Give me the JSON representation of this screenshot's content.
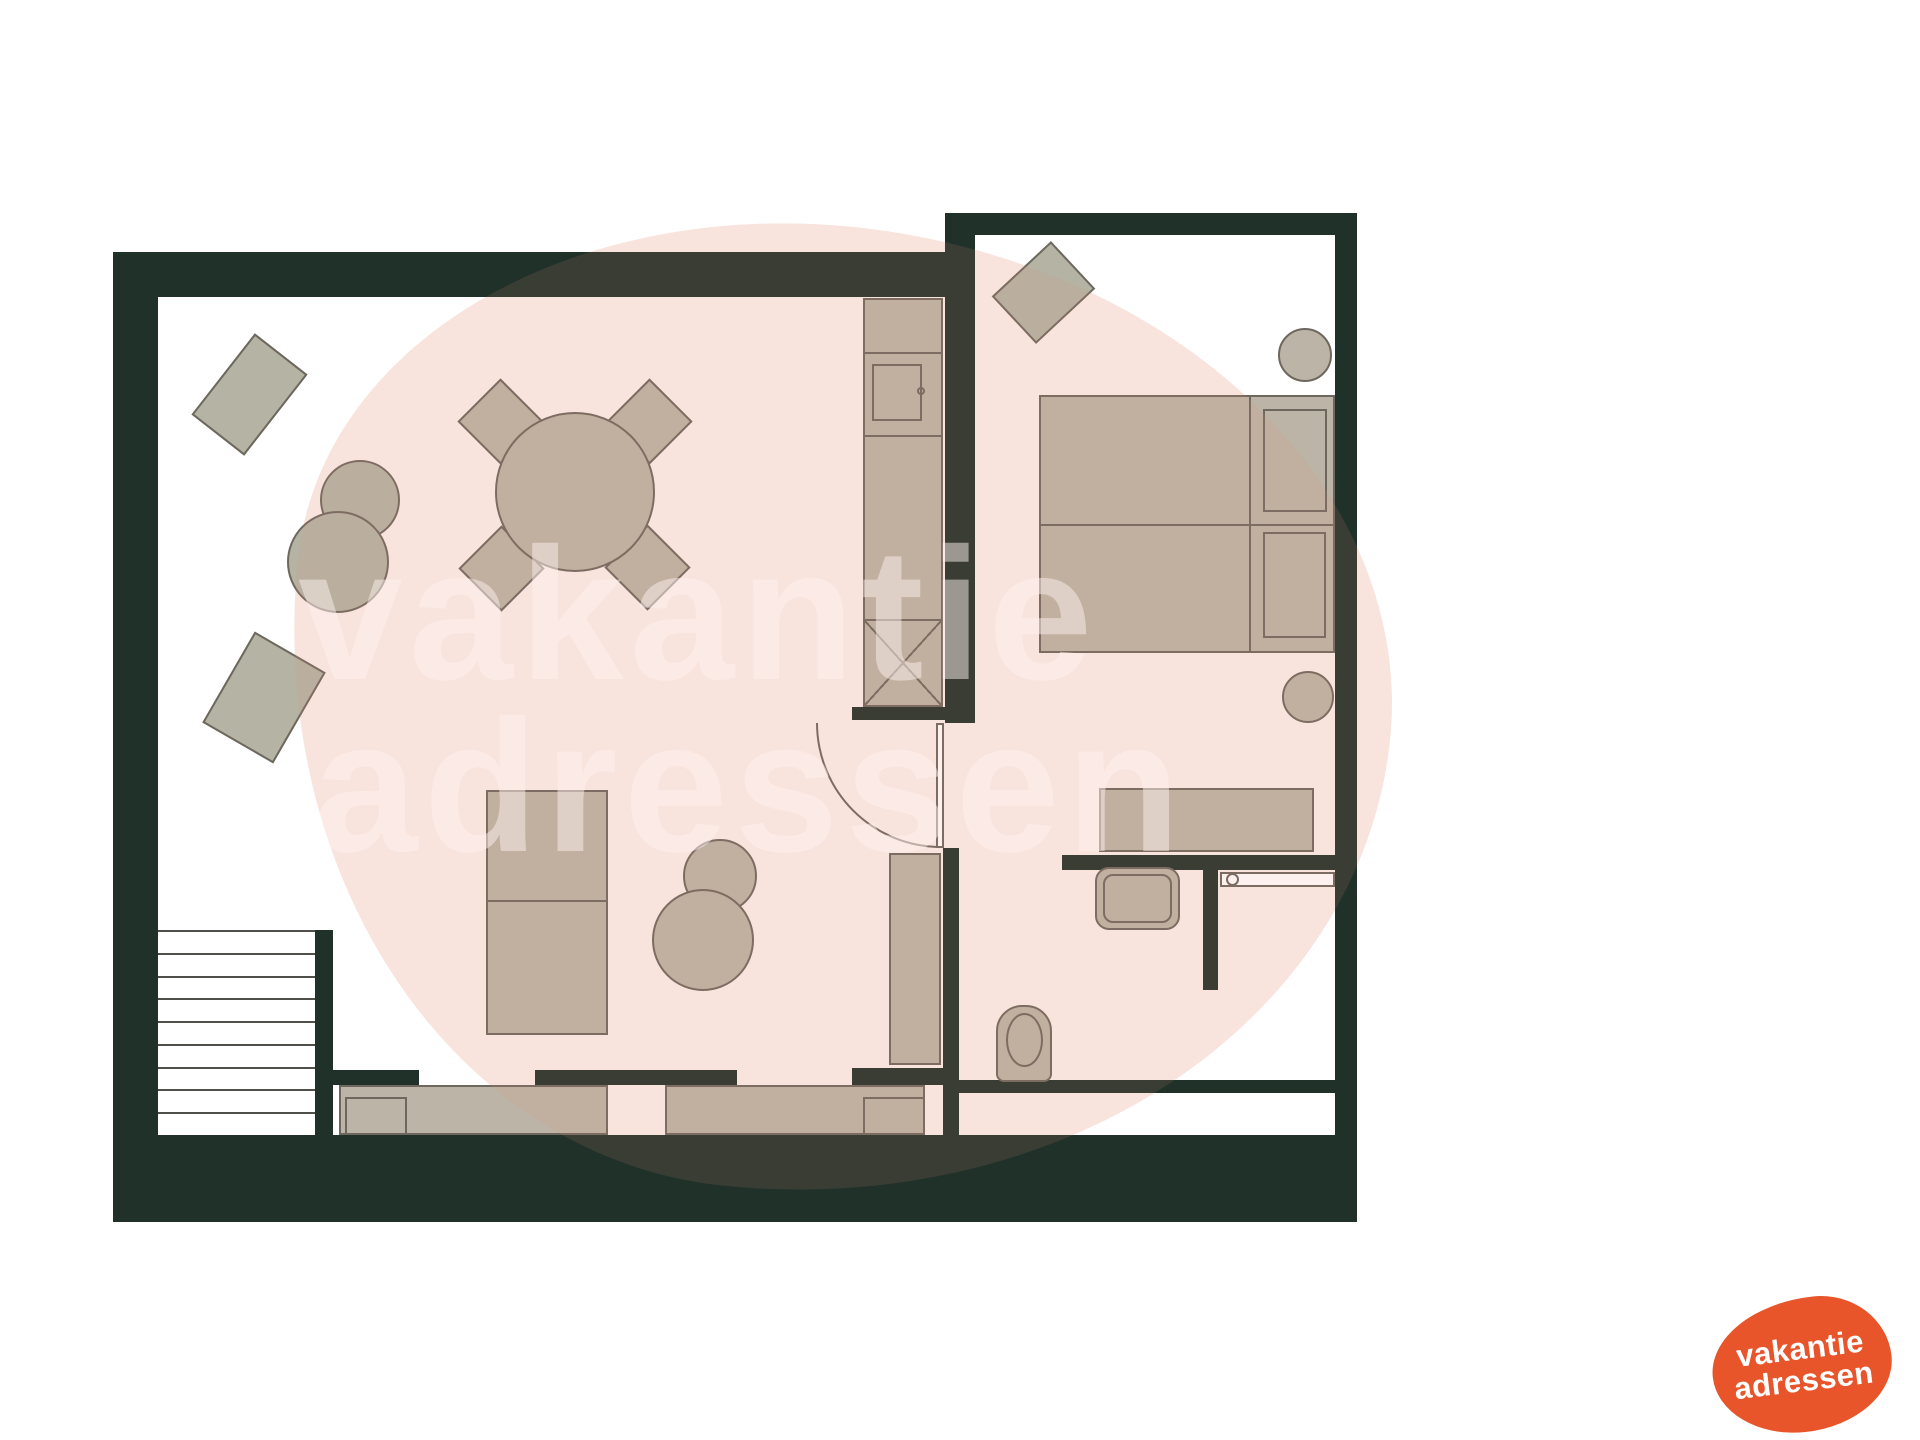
{
  "canvas": {
    "width": 1920,
    "height": 1440,
    "background": "#ffffff"
  },
  "colors": {
    "background": "#ffffff",
    "wall": "#20312a",
    "furniture": "#bcb4a6",
    "furniture_alt": "#b4b3a4",
    "edge": "#6e675d",
    "stair_line": "#50504a",
    "watermark_text": "rgba(255,255,255,0.5)",
    "blob_pink": "#fcefec",
    "blob_overlay": "rgba(235,148,122,0.13)",
    "logo_orange": "#e8552b"
  },
  "watermark": {
    "blob": {
      "x": 285,
      "y": 228,
      "w": 1105,
      "h": 967,
      "radius": "47% 53% 56% 44% / 40% 47% 53% 60%",
      "rotate": 6
    },
    "lines": [
      {
        "text": "vakantie",
        "x": 298,
        "y": 520,
        "size": 188,
        "spacing": 6
      },
      {
        "text": "adressen",
        "x": 313,
        "y": 692,
        "size": 188,
        "spacing": 6
      }
    ]
  },
  "logo": {
    "x": 1712,
    "y": 1298,
    "w": 180,
    "h": 134,
    "radius": "60% 40% 52% 48% / 52% 50% 50% 48%",
    "rotate": -6,
    "text_rotate": -7,
    "font_size": 31,
    "line_height": 1.02,
    "line1": "vakantie",
    "line2": "adressen"
  },
  "plan": {
    "elements": [
      {
        "name": "wall-left",
        "cls": "wall",
        "x": 113,
        "y": 252,
        "w": 45,
        "h": 883
      },
      {
        "name": "wall-top-living",
        "cls": "wall",
        "x": 113,
        "y": 252,
        "w": 862,
        "h": 45
      },
      {
        "name": "wall-right-living-upper",
        "cls": "wall",
        "x": 945,
        "y": 213,
        "w": 30,
        "h": 510
      },
      {
        "name": "wall-right-living-lower",
        "cls": "wall",
        "x": 943,
        "y": 848,
        "w": 16,
        "h": 287
      },
      {
        "name": "wall-top-bedroom",
        "cls": "wall",
        "x": 948,
        "y": 213,
        "w": 409,
        "h": 22
      },
      {
        "name": "wall-right-outer",
        "cls": "wall",
        "x": 1335,
        "y": 213,
        "w": 22,
        "h": 1009
      },
      {
        "name": "wall-divider-bedroom-bathroom",
        "cls": "wall",
        "x": 1062,
        "y": 855,
        "w": 275,
        "h": 15
      },
      {
        "name": "wall-shower-partition",
        "cls": "wall",
        "x": 1203,
        "y": 863,
        "w": 15,
        "h": 127
      },
      {
        "name": "wall-bathroom-bottom",
        "cls": "wall",
        "x": 958,
        "y": 1080,
        "w": 379,
        "h": 13
      },
      {
        "name": "wall-bottom-band",
        "cls": "wall",
        "x": 113,
        "y": 1135,
        "w": 1244,
        "h": 87
      },
      {
        "name": "wall-stairs-side",
        "cls": "wall",
        "x": 315,
        "y": 930,
        "w": 18,
        "h": 205
      },
      {
        "name": "wall-window-pier-left",
        "cls": "wall",
        "x": 326,
        "y": 1070,
        "w": 93,
        "h": 15
      },
      {
        "name": "wall-window-pier-middle",
        "cls": "wall",
        "x": 535,
        "y": 1070,
        "w": 202,
        "h": 15
      },
      {
        "name": "wall-window-pier-right",
        "cls": "wall",
        "x": 852,
        "y": 1068,
        "w": 91,
        "h": 17
      },
      {
        "name": "wall-door-stub",
        "cls": "wall",
        "x": 852,
        "y": 707,
        "w": 93,
        "h": 13
      },
      {
        "name": "staircase",
        "type": "stairs",
        "x": 158,
        "y": 930,
        "w": 157,
        "h": 205,
        "steps": 9
      },
      {
        "name": "rug-top-left",
        "cls": "furn2",
        "x": 198,
        "y": 361,
        "w": 103,
        "h": 67,
        "rot": -52
      },
      {
        "name": "pouf-small",
        "cls": "furn2 circle",
        "x": 320,
        "y": 460,
        "w": 80,
        "h": 80
      },
      {
        "name": "pouf-large",
        "cls": "furn2 circle",
        "x": 287,
        "y": 511,
        "w": 102,
        "h": 102
      },
      {
        "name": "rug-bottom-left",
        "cls": "furn2",
        "x": 223,
        "y": 645,
        "w": 82,
        "h": 105,
        "rot": 30
      },
      {
        "name": "dining-chair-top-left",
        "cls": "furn",
        "x": 470,
        "y": 391,
        "w": 61,
        "h": 61,
        "rot": 45
      },
      {
        "name": "dining-chair-top-right",
        "cls": "furn",
        "x": 619,
        "y": 391,
        "w": 61,
        "h": 61,
        "rot": 45
      },
      {
        "name": "dining-chair-bottom-left",
        "cls": "furn",
        "x": 471,
        "y": 538,
        "w": 61,
        "h": 61,
        "rot": 45
      },
      {
        "name": "dining-chair-bottom-right",
        "cls": "furn",
        "x": 617,
        "y": 537,
        "w": 61,
        "h": 61,
        "rot": 45
      },
      {
        "name": "dining-table",
        "cls": "furn circle",
        "x": 495,
        "y": 412,
        "w": 160,
        "h": 160
      },
      {
        "name": "kitchen-tall-unit",
        "cls": "furn",
        "x": 863,
        "y": 298,
        "w": 80,
        "h": 409
      },
      {
        "name": "kitchen-divider-top",
        "cls": "line",
        "x": 863,
        "y": 352,
        "w": 80,
        "h": 2
      },
      {
        "name": "kitchen-divider-mid",
        "cls": "line",
        "x": 863,
        "y": 435,
        "w": 80,
        "h": 2
      },
      {
        "name": "oven-door",
        "cls": "outline",
        "x": 872,
        "y": 364,
        "w": 50,
        "h": 57
      },
      {
        "name": "oven-knob",
        "cls": "outline circle",
        "x": 917,
        "y": 387,
        "w": 8,
        "h": 8
      },
      {
        "name": "kitchen-appliance-x",
        "type": "xbox",
        "x": 863,
        "y": 619,
        "w": 80,
        "h": 88
      },
      {
        "name": "tv-cabinet",
        "cls": "furn",
        "x": 486,
        "y": 790,
        "w": 122,
        "h": 245
      },
      {
        "name": "tv-cabinet-divider",
        "cls": "line",
        "x": 486,
        "y": 900,
        "w": 122,
        "h": 2
      },
      {
        "name": "side-table-small",
        "cls": "furn circle",
        "x": 683,
        "y": 839,
        "w": 74,
        "h": 74
      },
      {
        "name": "side-table-large",
        "cls": "furn circle",
        "x": 652,
        "y": 889,
        "w": 102,
        "h": 102
      },
      {
        "name": "window-bench-left",
        "cls": "furn",
        "x": 339,
        "y": 1085,
        "w": 269,
        "h": 50
      },
      {
        "name": "bench-armrest-left",
        "cls": "outline",
        "x": 345,
        "y": 1097,
        "w": 62,
        "h": 38
      },
      {
        "name": "window-bench-right",
        "cls": "furn",
        "x": 665,
        "y": 1085,
        "w": 260,
        "h": 50
      },
      {
        "name": "bench-armrest-right",
        "cls": "outline",
        "x": 863,
        "y": 1097,
        "w": 62,
        "h": 38
      },
      {
        "name": "hall-cabinet",
        "cls": "furn",
        "x": 889,
        "y": 853,
        "w": 52,
        "h": 212
      },
      {
        "name": "door-swing-arc",
        "type": "arc",
        "x": 816,
        "y": 723,
        "w": 125,
        "h": 125
      },
      {
        "name": "door-leaf",
        "cls": "white-out",
        "x": 936,
        "y": 723,
        "w": 8,
        "h": 125
      },
      {
        "name": "bedroom-rug",
        "cls": "furn2",
        "x": 1003,
        "y": 260,
        "w": 81,
        "h": 65,
        "rot": -43
      },
      {
        "name": "bedroom-stool-top",
        "cls": "furn circle",
        "x": 1278,
        "y": 328,
        "w": 54,
        "h": 54
      },
      {
        "name": "bed-mattress-left",
        "cls": "furn",
        "x": 1039,
        "y": 395,
        "w": 212,
        "h": 131
      },
      {
        "name": "bed-mattress-right",
        "cls": "furn",
        "x": 1039,
        "y": 524,
        "w": 212,
        "h": 129
      },
      {
        "name": "bed-headboard-left",
        "cls": "furn",
        "x": 1249,
        "y": 395,
        "w": 86,
        "h": 131
      },
      {
        "name": "bed-headboard-right",
        "cls": "furn",
        "x": 1249,
        "y": 524,
        "w": 86,
        "h": 129
      },
      {
        "name": "bed-pillow-left",
        "cls": "outline",
        "x": 1263,
        "y": 409,
        "w": 64,
        "h": 103
      },
      {
        "name": "bed-pillow-right",
        "cls": "outline",
        "x": 1263,
        "y": 532,
        "w": 63,
        "h": 106
      },
      {
        "name": "bedroom-stool-bottom",
        "cls": "furn circle",
        "x": 1282,
        "y": 671,
        "w": 52,
        "h": 52
      },
      {
        "name": "desk",
        "cls": "furn",
        "x": 1099,
        "y": 788,
        "w": 215,
        "h": 64
      },
      {
        "name": "washbasin",
        "cls": "furn",
        "x": 1095,
        "y": 867,
        "w": 85,
        "h": 63,
        "radius": "14px"
      },
      {
        "name": "washbasin-inner",
        "cls": "outline",
        "x": 1103,
        "y": 874,
        "w": 69,
        "h": 49,
        "radius": "10px"
      },
      {
        "name": "shower-rail",
        "cls": "white-out",
        "x": 1220,
        "y": 872,
        "w": 115,
        "h": 15
      },
      {
        "name": "shower-head",
        "cls": "white-out circle",
        "x": 1226,
        "y": 873,
        "w": 13,
        "h": 13
      },
      {
        "name": "toilet",
        "cls": "furn",
        "x": 996,
        "y": 1005,
        "w": 56,
        "h": 77,
        "radius": "26px 26px 8px 8px"
      },
      {
        "name": "toilet-seat",
        "cls": "outline",
        "x": 1006,
        "y": 1013,
        "w": 37,
        "h": 54,
        "radius": "50%"
      }
    ]
  }
}
